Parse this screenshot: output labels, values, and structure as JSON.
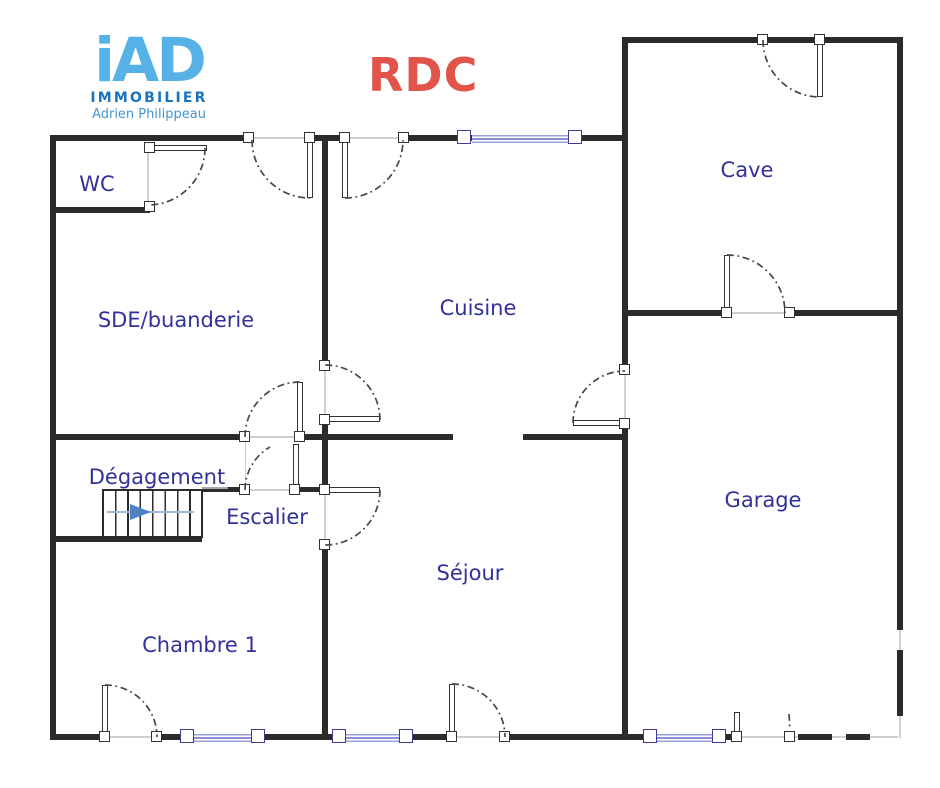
{
  "branding": {
    "logo_main": "iAD",
    "logo_sub": "IMMOBILIER",
    "logo_agent": "Adrien Philippeau",
    "logo_main_color": "#56b1e6",
    "logo_sub_color": "#1b74bb",
    "logo_agent_color": "#4596d2"
  },
  "title": {
    "text": "RDC",
    "color": "#e0544a"
  },
  "rooms": {
    "wc": "WC",
    "sde": "SDE/buanderie",
    "cuisine": "Cuisine",
    "cave": "Cave",
    "degagement": "Dégagement",
    "escalier": "Escalier",
    "sejour": "Séjour",
    "chambre1": "Chambre 1",
    "garage": "Garage"
  },
  "colors": {
    "wall": "#2b2b2b",
    "room_label": "#31319b",
    "window_frame": "#3c3c96",
    "window_glass": "#8890cf",
    "door_arc": "#474747",
    "stairs_arrow": "#4f82c4"
  }
}
